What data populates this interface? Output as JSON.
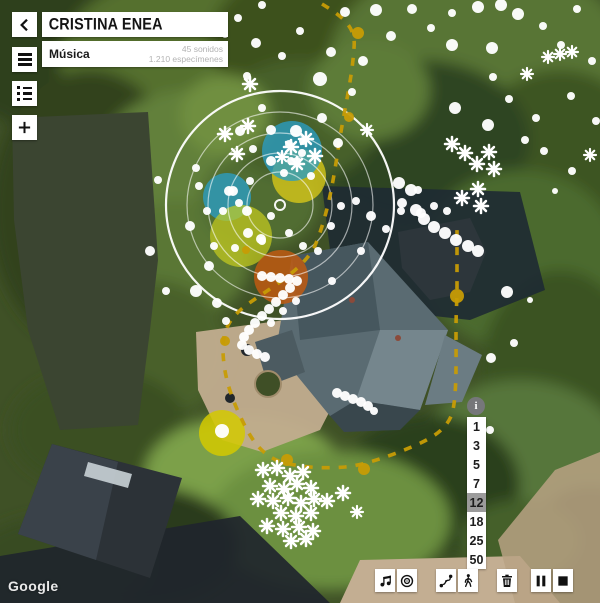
{
  "header": {
    "title": "CRISTINA ENEA",
    "category": "Música",
    "stats": [
      "45 sonidos",
      "1.210 especímenes"
    ],
    "back_icon": "chevron-left"
  },
  "nav_buttons": [
    {
      "name": "menu",
      "icon": "hamburger-icon"
    },
    {
      "name": "layers-list",
      "icon": "list-icon"
    },
    {
      "name": "add",
      "icon": "plus-icon"
    }
  ],
  "scale": {
    "info_label": "i",
    "values": [
      "1",
      "3",
      "5",
      "7",
      "12",
      "18",
      "25",
      "50"
    ],
    "selected": "12"
  },
  "toolbar": [
    {
      "name": "music"
    },
    {
      "name": "target"
    },
    {
      "name": "route"
    },
    {
      "name": "walk"
    },
    {
      "name": "trash"
    },
    {
      "name": "pause"
    },
    {
      "name": "stop"
    }
  ],
  "attribution": "Google",
  "colors": {
    "route_path": "#c79c05",
    "blue_blob": "#2a9dc4",
    "yellow_blob": "#e0cd18",
    "orange_blob": "#c05a12",
    "selected_scale_bg": "#9b9b9b"
  },
  "map_overlay": {
    "rings": {
      "cx": 280,
      "cy": 205,
      "radii": [
        114,
        93,
        72,
        52,
        33
      ],
      "center_r": 5
    },
    "blobs": [
      {
        "x": 299,
        "y": 176,
        "r": 27,
        "c": "#e0cd18",
        "o": 0.75
      },
      {
        "x": 292,
        "y": 151,
        "r": 30,
        "c": "#2a9dc4",
        "o": 0.78
      },
      {
        "x": 227,
        "y": 197,
        "r": 24,
        "c": "#2a9dc4",
        "o": 0.78
      },
      {
        "x": 241,
        "y": 236,
        "r": 31,
        "c": "#ccd01d",
        "o": 0.68
      },
      {
        "x": 281,
        "y": 277,
        "r": 27,
        "c": "#c05a12",
        "o": 0.85
      },
      {
        "x": 222,
        "y": 433,
        "r": 23,
        "c": "#d3c900",
        "o": 0.85
      }
    ],
    "dashed_path": "M322,4 C345,18 356,28 354,48 C352,80 344,110 338,150 C332,190 326,220 314,248 C300,272 270,288 248,304 C230,317 222,330 223,352 C224,378 232,400 244,424 C252,440 260,452 276,460 C295,467 320,469 345,467 C365,465 390,456 414,446 C432,438 446,430 452,414 C457,396 456,360 456,330 C456,312 457,300 457,290 L457,230",
    "path_dots": [
      [
        358,
        33,
        6
      ],
      [
        349,
        117,
        5
      ],
      [
        457,
        296,
        7
      ],
      [
        287,
        460,
        6
      ],
      [
        364,
        469,
        6
      ],
      [
        225,
        341,
        5
      ],
      [
        246,
        250,
        4
      ]
    ],
    "dots": [
      [
        238,
        18,
        4
      ],
      [
        256,
        43,
        5
      ],
      [
        247,
        76,
        4
      ],
      [
        262,
        108,
        4
      ],
      [
        271,
        130,
        5
      ],
      [
        296,
        131,
        6
      ],
      [
        320,
        79,
        7
      ],
      [
        331,
        52,
        5
      ],
      [
        345,
        12,
        5
      ],
      [
        376,
        10,
        6
      ],
      [
        391,
        36,
        5
      ],
      [
        363,
        61,
        5
      ],
      [
        352,
        92,
        4
      ],
      [
        322,
        118,
        5
      ],
      [
        338,
        143,
        5
      ],
      [
        300,
        31,
        4
      ],
      [
        282,
        56,
        4
      ],
      [
        412,
        9,
        5
      ],
      [
        431,
        28,
        4
      ],
      [
        452,
        13,
        4
      ],
      [
        478,
        7,
        6
      ],
      [
        501,
        5,
        6
      ],
      [
        518,
        14,
        6
      ],
      [
        452,
        45,
        6
      ],
      [
        492,
        48,
        6
      ],
      [
        493,
        77,
        4
      ],
      [
        509,
        99,
        4
      ],
      [
        455,
        108,
        6
      ],
      [
        488,
        125,
        6
      ],
      [
        543,
        26,
        4
      ],
      [
        561,
        45,
        4
      ],
      [
        577,
        9,
        4
      ],
      [
        592,
        61,
        4
      ],
      [
        571,
        96,
        4
      ],
      [
        596,
        121,
        4
      ],
      [
        544,
        151,
        4
      ],
      [
        572,
        171,
        4
      ],
      [
        555,
        191,
        3
      ],
      [
        536,
        118,
        4
      ],
      [
        525,
        140,
        4
      ],
      [
        262,
        5,
        4
      ],
      [
        225,
        35,
        3
      ],
      [
        158,
        180,
        4
      ],
      [
        150,
        251,
        5
      ],
      [
        166,
        291,
        4
      ],
      [
        196,
        168,
        4
      ],
      [
        199,
        186,
        4
      ],
      [
        207,
        211,
        4
      ],
      [
        190,
        226,
        5
      ],
      [
        214,
        246,
        4
      ],
      [
        209,
        266,
        5
      ],
      [
        196,
        291,
        6
      ],
      [
        217,
        303,
        5
      ],
      [
        226,
        321,
        4
      ],
      [
        240,
        131,
        5
      ],
      [
        253,
        149,
        4
      ],
      [
        271,
        161,
        5
      ],
      [
        250,
        181,
        4
      ],
      [
        233,
        191,
        5
      ],
      [
        247,
        211,
        5
      ],
      [
        271,
        216,
        4
      ],
      [
        291,
        161,
        4
      ],
      [
        302,
        153,
        4
      ],
      [
        311,
        176,
        4
      ],
      [
        261,
        239,
        5
      ],
      [
        289,
        233,
        4
      ],
      [
        303,
        246,
        4
      ],
      [
        318,
        251,
        4
      ],
      [
        331,
        226,
        4
      ],
      [
        341,
        206,
        4
      ],
      [
        289,
        144,
        4
      ],
      [
        303,
        141,
        4
      ],
      [
        297,
        161,
        4
      ],
      [
        284,
        173,
        4
      ],
      [
        229,
        191,
        5
      ],
      [
        239,
        203,
        4
      ],
      [
        223,
        211,
        4
      ],
      [
        248,
        233,
        5
      ],
      [
        262,
        241,
        4
      ],
      [
        235,
        248,
        4
      ],
      [
        296,
        301,
        4
      ],
      [
        283,
        311,
        4
      ],
      [
        271,
        323,
        4
      ],
      [
        356,
        201,
        4
      ],
      [
        371,
        216,
        5
      ],
      [
        386,
        229,
        4
      ],
      [
        401,
        211,
        4
      ],
      [
        421,
        213,
        5
      ],
      [
        434,
        206,
        4
      ],
      [
        447,
        211,
        4
      ],
      [
        361,
        251,
        4
      ],
      [
        332,
        281,
        4
      ],
      [
        507,
        292,
        6
      ],
      [
        491,
        358,
        5
      ],
      [
        514,
        343,
        4
      ],
      [
        490,
        430,
        4
      ],
      [
        530,
        300,
        3
      ],
      [
        418,
        190,
        4
      ],
      [
        399,
        183,
        6
      ],
      [
        411,
        190,
        6
      ],
      [
        402,
        203,
        5
      ],
      [
        416,
        210,
        6
      ],
      [
        424,
        219,
        6
      ],
      [
        434,
        227,
        6
      ],
      [
        445,
        233,
        6
      ],
      [
        456,
        240,
        6
      ],
      [
        468,
        246,
        6
      ],
      [
        478,
        251,
        6
      ],
      [
        262,
        276,
        5
      ],
      [
        271,
        277,
        5
      ],
      [
        280,
        278,
        5
      ],
      [
        289,
        279,
        5
      ],
      [
        297,
        281,
        5
      ],
      [
        290,
        288,
        5
      ],
      [
        283,
        295,
        5
      ],
      [
        276,
        302,
        5
      ],
      [
        269,
        309,
        5
      ],
      [
        262,
        316,
        5
      ],
      [
        255,
        323,
        5
      ],
      [
        249,
        330,
        5
      ],
      [
        244,
        337,
        5
      ],
      [
        242,
        345,
        5
      ],
      [
        249,
        350,
        5
      ],
      [
        257,
        354,
        5
      ],
      [
        265,
        357,
        5
      ],
      [
        337,
        393,
        5
      ],
      [
        345,
        396,
        5
      ],
      [
        353,
        399,
        5
      ],
      [
        361,
        402,
        5
      ],
      [
        368,
        406,
        5
      ],
      [
        374,
        411,
        4
      ],
      [
        222,
        431,
        7
      ]
    ],
    "flakes": [
      [
        250,
        84,
        7
      ],
      [
        248,
        126,
        7
      ],
      [
        225,
        134,
        7
      ],
      [
        237,
        154,
        7
      ],
      [
        291,
        147,
        7
      ],
      [
        306,
        139,
        7
      ],
      [
        315,
        156,
        7
      ],
      [
        297,
        164,
        7
      ],
      [
        282,
        157,
        6
      ],
      [
        367,
        130,
        6
      ],
      [
        452,
        144,
        7
      ],
      [
        465,
        153,
        7
      ],
      [
        489,
        152,
        7
      ],
      [
        477,
        164,
        7
      ],
      [
        494,
        169,
        7
      ],
      [
        478,
        189,
        7
      ],
      [
        462,
        198,
        7
      ],
      [
        481,
        206,
        7
      ],
      [
        548,
        57,
        6
      ],
      [
        560,
        54,
        6
      ],
      [
        572,
        52,
        6
      ],
      [
        527,
        74,
        6
      ],
      [
        590,
        155,
        6
      ],
      [
        263,
        470,
        7
      ],
      [
        277,
        468,
        7
      ],
      [
        290,
        476,
        7
      ],
      [
        303,
        472,
        7
      ],
      [
        270,
        486,
        7
      ],
      [
        284,
        489,
        7
      ],
      [
        297,
        484,
        7
      ],
      [
        311,
        488,
        7
      ],
      [
        258,
        499,
        7
      ],
      [
        273,
        501,
        7
      ],
      [
        288,
        498,
        7
      ],
      [
        301,
        503,
        7
      ],
      [
        314,
        499,
        7
      ],
      [
        327,
        501,
        7
      ],
      [
        343,
        493,
        7
      ],
      [
        281,
        513,
        7
      ],
      [
        296,
        516,
        7
      ],
      [
        311,
        513,
        7
      ],
      [
        267,
        526,
        7
      ],
      [
        283,
        529,
        7
      ],
      [
        299,
        527,
        7
      ],
      [
        313,
        531,
        7
      ],
      [
        291,
        541,
        7
      ],
      [
        306,
        539,
        7
      ],
      [
        357,
        512,
        6
      ]
    ]
  }
}
